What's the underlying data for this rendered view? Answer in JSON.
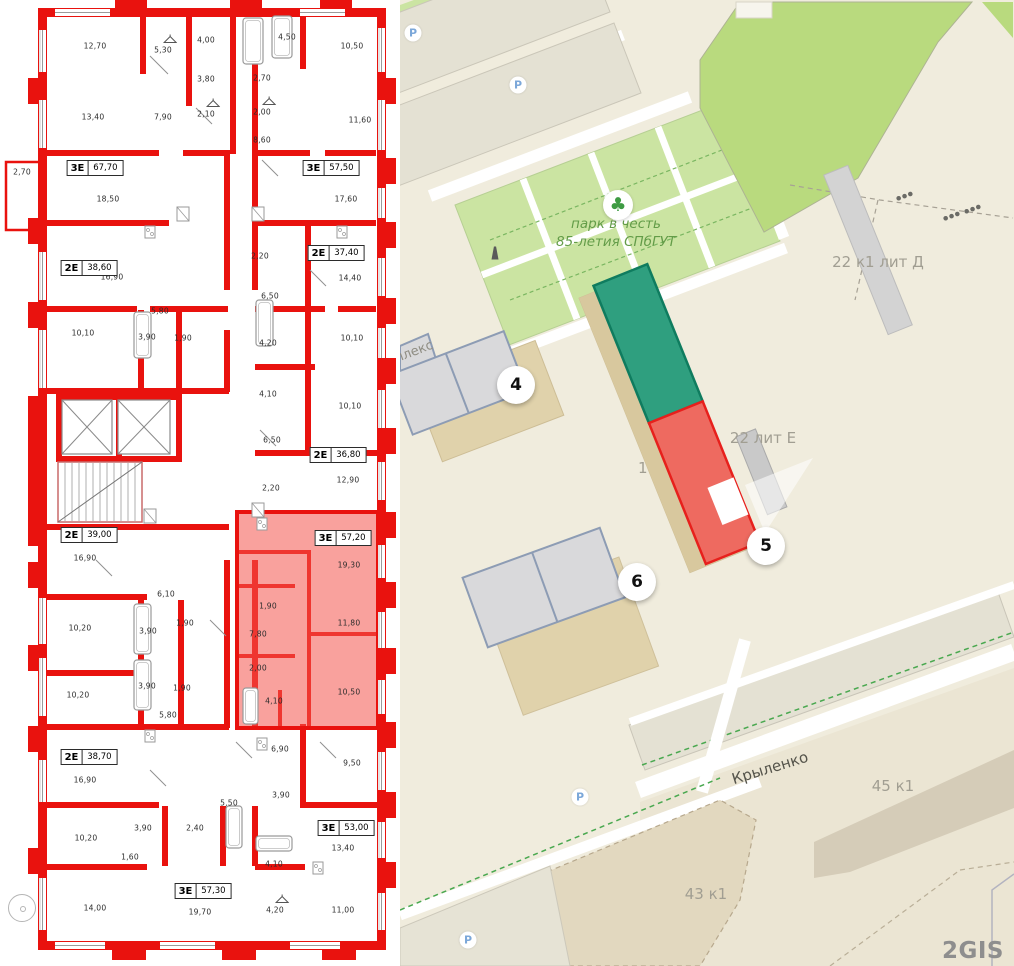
{
  "floorplan": {
    "balcony_area": "2,70",
    "units": [
      {
        "type": "3Е",
        "area": "67,70",
        "x": 95,
        "y": 168
      },
      {
        "type": "3Е",
        "area": "57,50",
        "x": 331,
        "y": 168
      },
      {
        "type": "2Е",
        "area": "38,60",
        "x": 89,
        "y": 268
      },
      {
        "type": "2Е",
        "area": "37,40",
        "x": 336,
        "y": 253
      },
      {
        "type": "2Е",
        "area": "36,80",
        "x": 338,
        "y": 455
      },
      {
        "type": "2Е",
        "area": "39,00",
        "x": 89,
        "y": 535
      },
      {
        "type": "3Е",
        "area": "57,20",
        "x": 343,
        "y": 538,
        "highlighted": true
      },
      {
        "type": "2Е",
        "area": "38,70",
        "x": 89,
        "y": 757
      },
      {
        "type": "3Е",
        "area": "53,00",
        "x": 346,
        "y": 828
      },
      {
        "type": "3Е",
        "area": "57,30",
        "x": 203,
        "y": 891
      }
    ],
    "rooms": [
      {
        "text": "12,70",
        "x": 95,
        "y": 46
      },
      {
        "text": "5,30",
        "x": 163,
        "y": 50,
        "hanger": true
      },
      {
        "text": "4,00",
        "x": 206,
        "y": 40
      },
      {
        "text": "4,50",
        "x": 287,
        "y": 37
      },
      {
        "text": "10,50",
        "x": 352,
        "y": 46
      },
      {
        "text": "13,40",
        "x": 93,
        "y": 117
      },
      {
        "text": "7,90",
        "x": 163,
        "y": 117
      },
      {
        "text": "3,80",
        "x": 206,
        "y": 79
      },
      {
        "text": "2,70",
        "x": 262,
        "y": 78
      },
      {
        "text": "2,10",
        "x": 206,
        "y": 114,
        "hanger": true
      },
      {
        "text": "2,00",
        "x": 262,
        "y": 112,
        "hanger": true
      },
      {
        "text": "11,60",
        "x": 360,
        "y": 120
      },
      {
        "text": "8,60",
        "x": 262,
        "y": 140
      },
      {
        "text": "2,70",
        "x": 22,
        "y": 172
      },
      {
        "text": "18,50",
        "x": 108,
        "y": 199
      },
      {
        "text": "17,60",
        "x": 346,
        "y": 199
      },
      {
        "text": "16,90",
        "x": 112,
        "y": 277
      },
      {
        "text": "2,20",
        "x": 260,
        "y": 256
      },
      {
        "text": "14,40",
        "x": 350,
        "y": 278
      },
      {
        "text": "6,50",
        "x": 270,
        "y": 296
      },
      {
        "text": "5,80",
        "x": 160,
        "y": 311
      },
      {
        "text": "10,10",
        "x": 83,
        "y": 333
      },
      {
        "text": "3,90",
        "x": 147,
        "y": 337
      },
      {
        "text": "1,90",
        "x": 183,
        "y": 338
      },
      {
        "text": "4,20",
        "x": 268,
        "y": 343
      },
      {
        "text": "10,10",
        "x": 352,
        "y": 338
      },
      {
        "text": "4,10",
        "x": 268,
        "y": 394
      },
      {
        "text": "10,10",
        "x": 350,
        "y": 406
      },
      {
        "text": "6,50",
        "x": 272,
        "y": 440
      },
      {
        "text": "2,20",
        "x": 271,
        "y": 488
      },
      {
        "text": "12,90",
        "x": 348,
        "y": 480
      },
      {
        "text": "16,90",
        "x": 85,
        "y": 558
      },
      {
        "text": "6,10",
        "x": 166,
        "y": 594
      },
      {
        "text": "10,20",
        "x": 80,
        "y": 628
      },
      {
        "text": "3,90",
        "x": 148,
        "y": 631
      },
      {
        "text": "1,90",
        "x": 185,
        "y": 623
      },
      {
        "text": "3,90",
        "x": 147,
        "y": 686
      },
      {
        "text": "1,90",
        "x": 182,
        "y": 688
      },
      {
        "text": "10,20",
        "x": 78,
        "y": 695
      },
      {
        "text": "5,80",
        "x": 168,
        "y": 715
      },
      {
        "text": "19,30",
        "x": 349,
        "y": 565
      },
      {
        "text": "1,90",
        "x": 268,
        "y": 606
      },
      {
        "text": "11,80",
        "x": 349,
        "y": 623
      },
      {
        "text": "7,80",
        "x": 258,
        "y": 634
      },
      {
        "text": "2,00",
        "x": 258,
        "y": 668
      },
      {
        "text": "4,10",
        "x": 274,
        "y": 701
      },
      {
        "text": "10,50",
        "x": 349,
        "y": 692
      },
      {
        "text": "6,90",
        "x": 280,
        "y": 749
      },
      {
        "text": "9,50",
        "x": 352,
        "y": 763
      },
      {
        "text": "16,90",
        "x": 85,
        "y": 780
      },
      {
        "text": "3,90",
        "x": 281,
        "y": 795
      },
      {
        "text": "5,50",
        "x": 229,
        "y": 803
      },
      {
        "text": "10,20",
        "x": 86,
        "y": 838
      },
      {
        "text": "3,90",
        "x": 143,
        "y": 828
      },
      {
        "text": "2,40",
        "x": 195,
        "y": 828
      },
      {
        "text": "13,40",
        "x": 343,
        "y": 848
      },
      {
        "text": "1,60",
        "x": 130,
        "y": 857
      },
      {
        "text": "4,10",
        "x": 274,
        "y": 864
      },
      {
        "text": "14,00",
        "x": 95,
        "y": 908
      },
      {
        "text": "19,70",
        "x": 200,
        "y": 912
      },
      {
        "text": "4,20",
        "x": 275,
        "y": 910,
        "hanger": true
      },
      {
        "text": "11,00",
        "x": 343,
        "y": 910
      }
    ]
  },
  "map": {
    "markers": [
      {
        "label": "4",
        "x": 116,
        "y": 385
      },
      {
        "label": "5",
        "x": 366,
        "y": 546
      },
      {
        "label": "6",
        "x": 237,
        "y": 582
      }
    ],
    "labels": [
      {
        "text": "плекс",
        "x": 14,
        "y": 352,
        "rot": -21,
        "cls": "street"
      },
      {
        "text": "22 к1 лит Д",
        "x": 478,
        "y": 262,
        "cls": "bldg"
      },
      {
        "text": "22 лит Е",
        "x": 363,
        "y": 438,
        "cls": "bldg"
      },
      {
        "text": "1-я",
        "x": 250,
        "y": 468,
        "cls": "bldg",
        "under": true
      },
      {
        "text": "45 к1",
        "x": 493,
        "y": 786,
        "cls": "bldg"
      },
      {
        "text": "43 к1",
        "x": 306,
        "y": 894,
        "cls": "bldg"
      },
      {
        "text": "Крыленко",
        "x": 370,
        "y": 768,
        "rot": -17,
        "cls": "street-name"
      }
    ],
    "park_label": {
      "lines": [
        "парк в честь",
        "85-летия СПбГУТ"
      ],
      "x": 216,
      "y": 233
    },
    "icons": [
      {
        "kind": "tree",
        "x": 218,
        "y": 205
      },
      {
        "kind": "parking",
        "x": 118,
        "y": 85
      },
      {
        "kind": "bike-parking",
        "x": 13,
        "y": 33
      },
      {
        "kind": "parking",
        "x": 180,
        "y": 797
      },
      {
        "kind": "parking",
        "x": 68,
        "y": 940
      },
      {
        "kind": "monument",
        "x": 95,
        "y": 253
      },
      {
        "kind": "gate",
        "x": 505,
        "y": 196
      },
      {
        "kind": "gate",
        "x": 552,
        "y": 216
      },
      {
        "kind": "gate",
        "x": 573,
        "y": 209
      }
    ],
    "watermark": {
      "text": "2GIS"
    },
    "colors": {
      "map_bg": "#f0ecdd",
      "park_green": "#cbe4a2",
      "field_green": "#b9da7e",
      "building_green": "#2f9f7f",
      "building_green_border": "#0f7c5f",
      "building_red": "#ee6a60",
      "building_red_border": "#e7201c",
      "roof_gray": "#d9d9db",
      "roof_stroke": "#8d9cb4",
      "base_tan": "#e0d2ab",
      "wall_red": "#e9120e",
      "highlight": "rgba(244,84,76,0.55)"
    }
  }
}
